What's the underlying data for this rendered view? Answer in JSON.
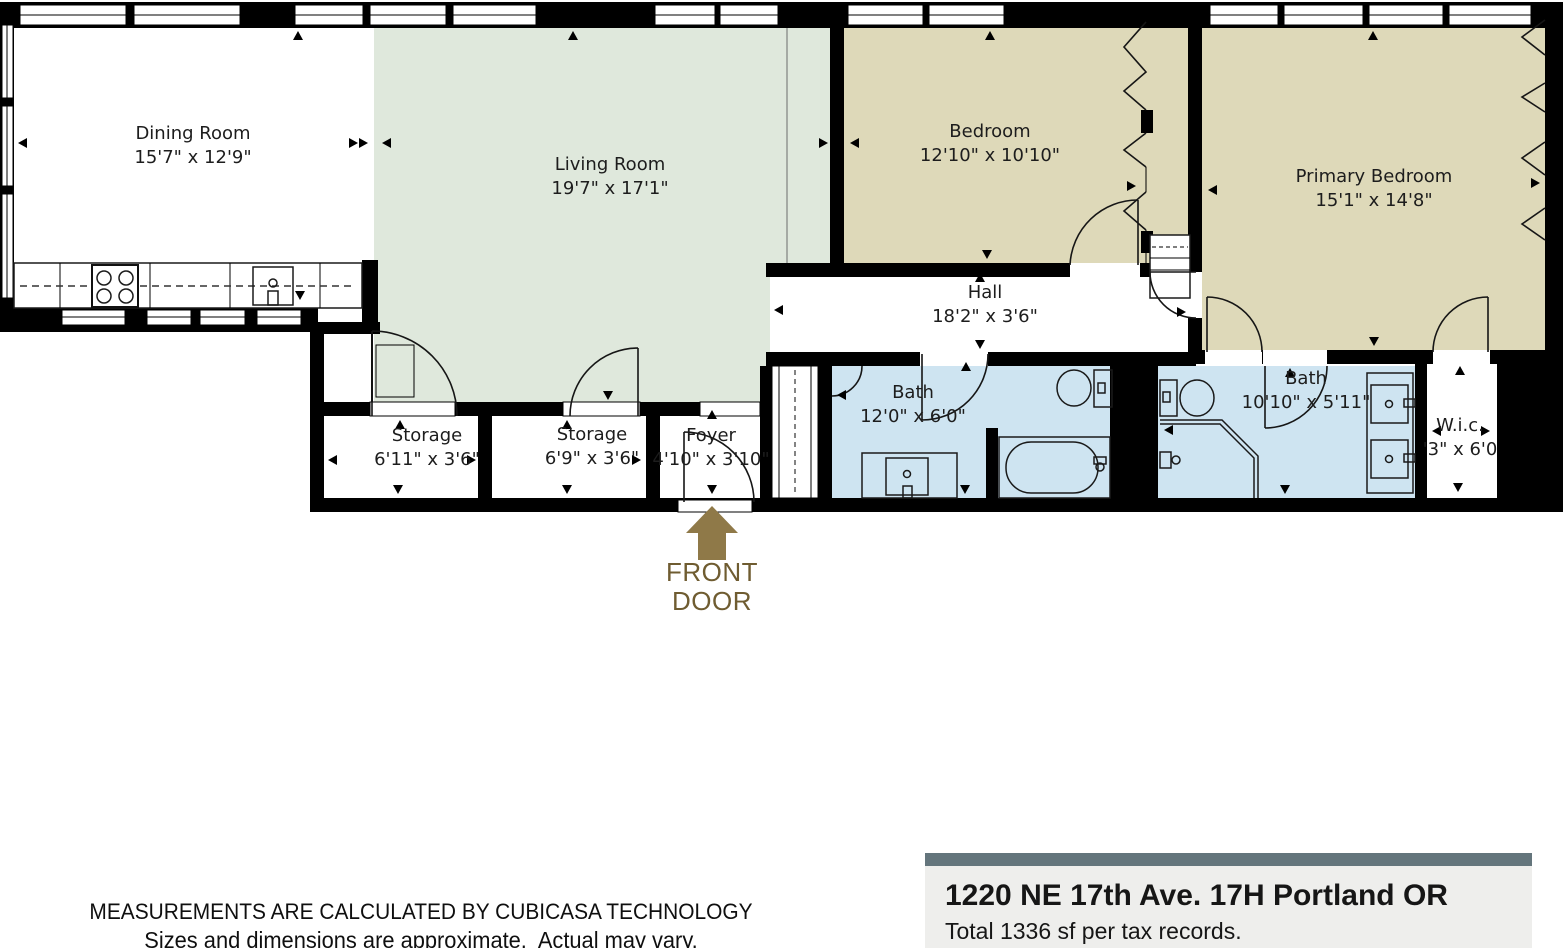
{
  "plan": {
    "rooms": [
      {
        "name": "Dining Room",
        "dims": "15'7\" x 12'9\""
      },
      {
        "name": "Living Room",
        "dims": "19'7\" x 17'1\""
      },
      {
        "name": "Bedroom",
        "dims": "12'10\" x 10'10\""
      },
      {
        "name": "Primary Bedroom",
        "dims": "15'1\" x 14'8\""
      },
      {
        "name": "Hall",
        "dims": "18'2\" x 3'6\""
      },
      {
        "name": "Bath",
        "dims": "12'0\" x 6'0\""
      },
      {
        "name": "Bath",
        "dims": "10'10\" x 5'11\""
      },
      {
        "name": "W.i.c.",
        "dims": "'3\" x 6'0"
      },
      {
        "name": "Storage",
        "dims": "6'11\" x 3'6\""
      },
      {
        "name": "Storage",
        "dims": "6'9\" x 3'6\""
      },
      {
        "name": "Foyer",
        "dims": "4'10\" x 3'10\""
      }
    ],
    "front_door_label": "FRONT DOOR",
    "colors": {
      "wall": "#000000",
      "living_room_floor": "#dfe8dc",
      "bedroom_floor": "#ded9b9",
      "bath_floor": "#cee4f1",
      "front_door_arrow": "#8f7948",
      "front_door_text": "#6f5c31",
      "address_bar": "#64757c",
      "address_bg": "#eeeeec"
    },
    "icons": [
      "front-door-arrow-icon",
      "stove-icon",
      "kitchen-sink-icon",
      "toilet-icon",
      "bathtub-icon",
      "shower-icon",
      "vanity-sink-icon",
      "double-vanity-icon",
      "washer-dryer-icon",
      "closet-bifold-icon",
      "window-icon",
      "door-swing-icon",
      "dimension-arrow-icon"
    ]
  },
  "footer": {
    "disclaimer_line1": "MEASUREMENTS ARE CALCULATED BY CUBICASA TECHNOLOGY",
    "disclaimer_line2": "Sizes and dimensions are approximate.  Actual may vary.",
    "address": "1220 NE 17th Ave. 17H Portland OR",
    "total_area": "Total 1336 sf per tax records."
  }
}
